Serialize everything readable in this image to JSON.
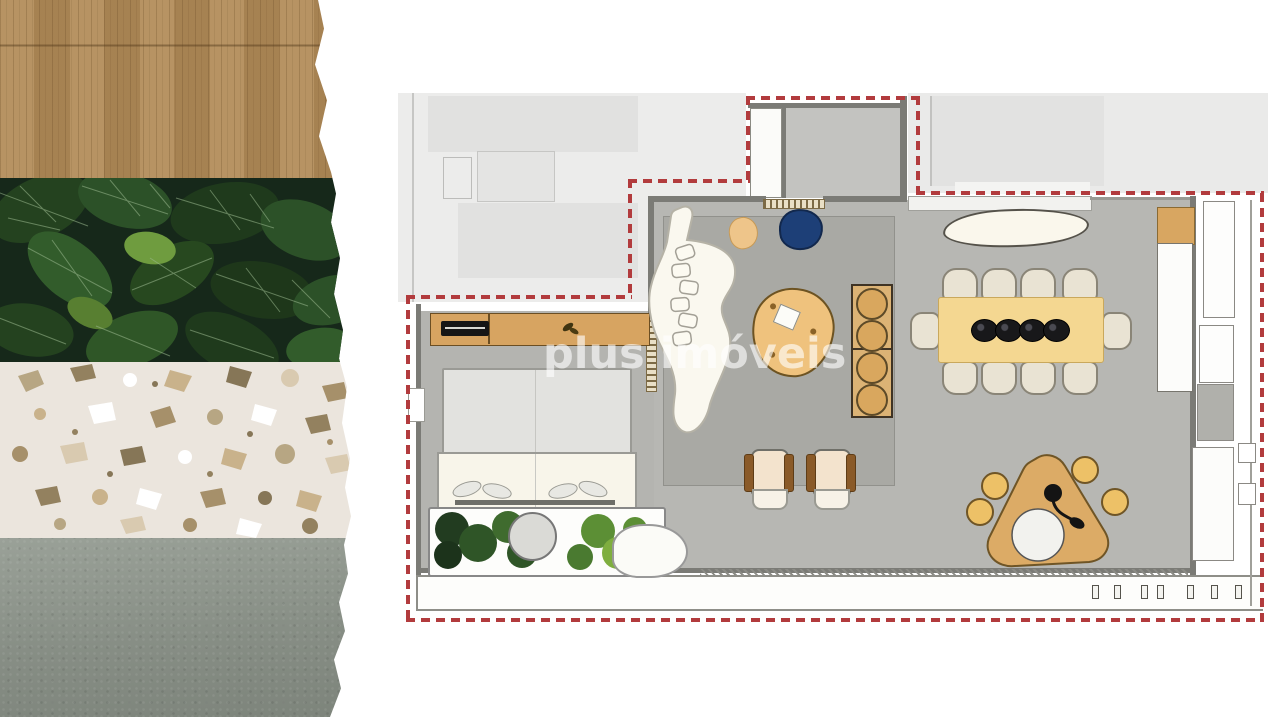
{
  "watermark": {
    "text": "plus imóveis"
  },
  "collage": {
    "sections": [
      {
        "name": "wood-panel",
        "material": "oak wood veneer"
      },
      {
        "name": "foliage-panel",
        "material": "tropical leaves"
      },
      {
        "name": "terrazzo-panel",
        "material": "terrazzo stone"
      },
      {
        "name": "concrete-panel",
        "material": "gray concrete"
      }
    ]
  },
  "plan": {
    "type": "apartment-floor-plan",
    "boundary": {
      "style": "dashed",
      "color": "#b23b3d"
    },
    "rooms": [
      "entry-hall",
      "living-room",
      "dining-area",
      "kitchen",
      "bedroom",
      "balcony",
      "adjacent-unit"
    ],
    "furniture": [
      "curved-sofa",
      "coffee-table",
      "navy-armchair",
      "ottoman",
      "armchair",
      "armchair",
      "dining-table-10-seats",
      "dish-set",
      "round-shelf-console",
      "kitchen-counter",
      "island-triangle-table",
      "bar-stool",
      "bar-stool",
      "bar-stool",
      "bar-stool",
      "bed",
      "tv-sideboard",
      "tv",
      "planter-with-plants",
      "round-side-table",
      "wardrobe",
      "cabinet",
      "balcony-rail"
    ]
  },
  "palette": {
    "boundary_red": "#b23b3d",
    "wood": "#b08a58",
    "leaf_green": "#2c5128",
    "terrazzo": "#ebe5dd",
    "concrete": "#878e85",
    "floor_gray": "#b7b7b3",
    "rug_gray": "#a9a9a4",
    "adjacent_gray": "#ececeb",
    "furniture_tan": "#d9a75e",
    "dining_table_yellow": "#f4d791",
    "sofa_cream": "#faf8ef",
    "navy_chair": "#1d3f77"
  }
}
